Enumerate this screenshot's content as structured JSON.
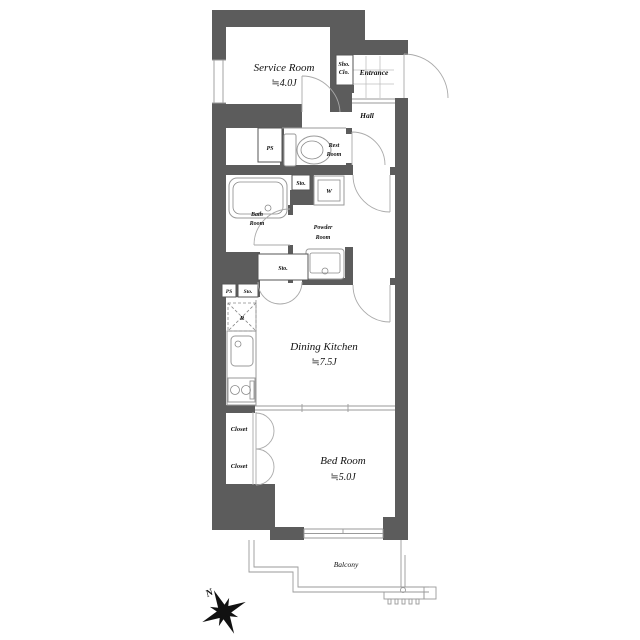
{
  "meta": {
    "type": "apartment-floor-plan"
  },
  "colors": {
    "wall": "#5c5c5c",
    "line": "#9a9a9a",
    "text": "#111111",
    "background": "#ffffff"
  },
  "rooms": {
    "service_room": {
      "name": "Service Room",
      "size": "≒4.0J"
    },
    "shoe_closet": {
      "abbr_line1": "Sho.",
      "abbr_line2": "Clo."
    },
    "entrance": {
      "name": "Entrance"
    },
    "hall": {
      "name": "Hall"
    },
    "pipe_space_upper": {
      "abbr": "PS"
    },
    "rest_room": {
      "name_line1": "Rest",
      "name_line2": "Room"
    },
    "storage_upper": {
      "abbr": "Sto."
    },
    "washing_machine": {
      "abbr": "W"
    },
    "bath_room": {
      "name_line1": "Bath",
      "name_line2": "Room"
    },
    "powder_room": {
      "name_line1": "Powder",
      "name_line2": "Room"
    },
    "storage_mid": {
      "abbr": "Sto."
    },
    "pipe_space_lower": {
      "abbr": "PS"
    },
    "storage_lower": {
      "abbr": "Sto."
    },
    "refrigerator": {
      "abbr": "R"
    },
    "dining_kitchen": {
      "name": "Dining Kitchen",
      "size": "≒7.5J"
    },
    "closet_upper": {
      "name": "Closet"
    },
    "closet_lower": {
      "name": "Closet"
    },
    "bed_room": {
      "name": "Bed Room",
      "size": "≒5.0J"
    },
    "balcony": {
      "name": "Balcony"
    }
  },
  "compass": {
    "north_label": "N"
  }
}
